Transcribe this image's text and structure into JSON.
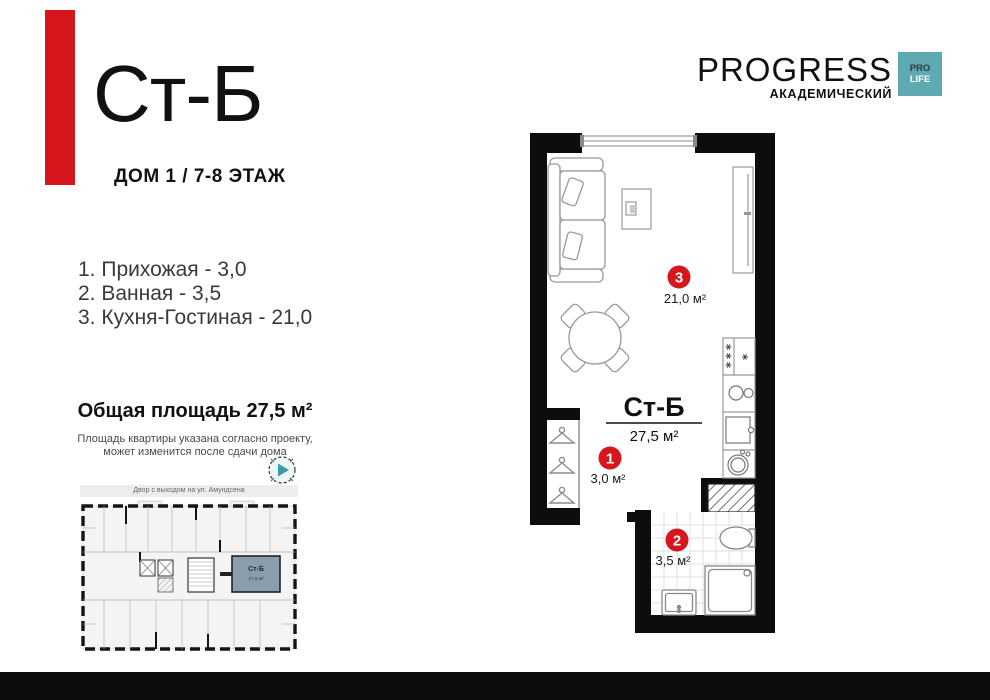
{
  "header": {
    "flat_code": "Ст-Б",
    "building_floor": "ДОМ 1 / 7-8 ЭТАЖ",
    "accent_color": "#d5161d"
  },
  "logo": {
    "brand": "PROGRESS",
    "subtitle": "АКАДЕМИЧЕСКИЙ",
    "badge": {
      "line1": "PRO",
      "line2": "LIFE",
      "bg": "#5fa9b3"
    }
  },
  "room_list": {
    "items": [
      "1. Прихожая - 3,0",
      "2. Ванная - 3,5",
      "3. Кухня-Гостиная - 21,0"
    ]
  },
  "summary": {
    "total_area": "Общая площадь 27,5 м²",
    "disclaimer_line1": "Площадь квартиры указана согласно проекту,",
    "disclaimer_line2": "может изменится после сдачи дома"
  },
  "site_plan": {
    "caption": "Двор с выходом на ул. Амундсена",
    "unit_label": "Ст-Б",
    "unit_area": "27,5 м²",
    "highlight_color": "#8a9dad"
  },
  "floor_plan": {
    "unit_title": "Ст-Б",
    "unit_area": "27,5 м²",
    "marker_color": "#d5161d",
    "markers": [
      {
        "num": "1",
        "area": "3,0 м²"
      },
      {
        "num": "2",
        "area": "3,5 м²"
      },
      {
        "num": "3",
        "area": "21,0 м²"
      }
    ]
  }
}
